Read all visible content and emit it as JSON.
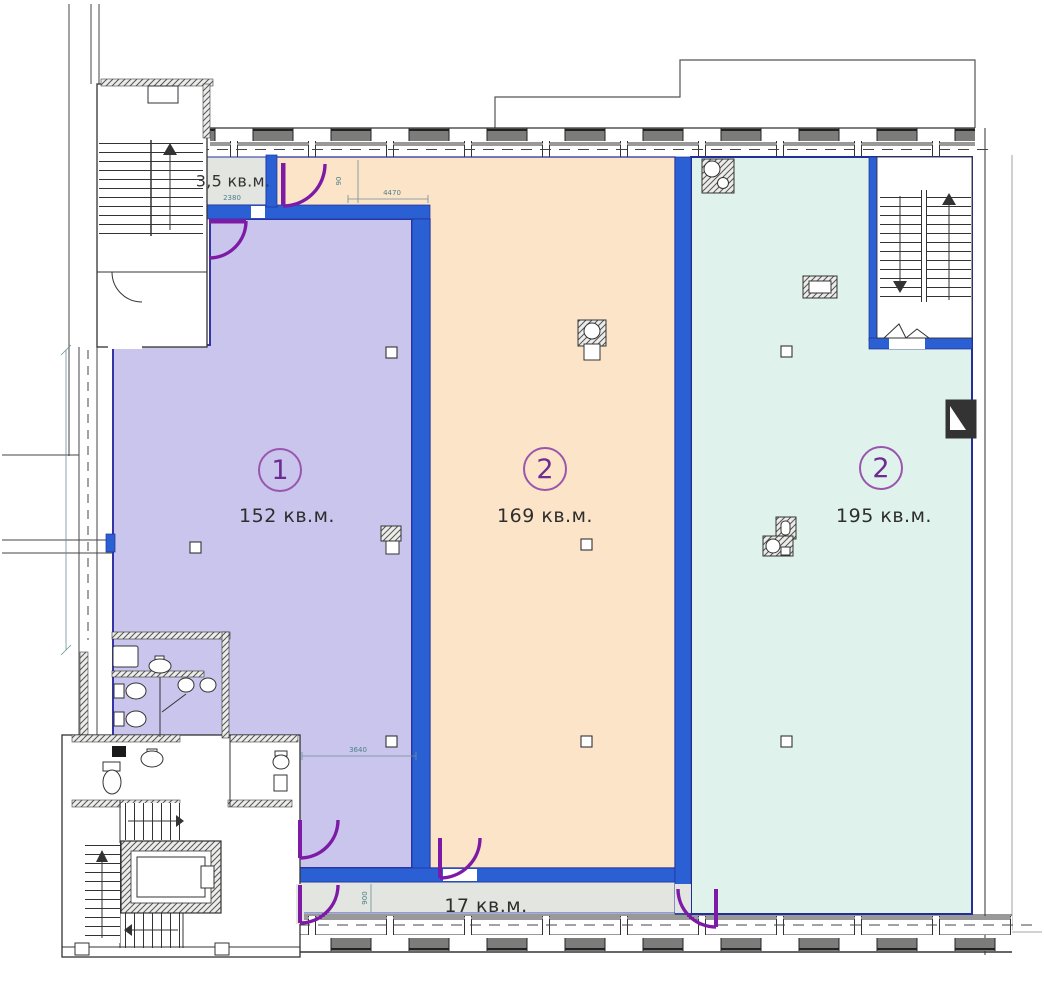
{
  "rooms": [
    {
      "number": "1",
      "area": "152 кв.м."
    },
    {
      "number": "2",
      "area": "169 кв.м."
    },
    {
      "number": "2",
      "area": "195 кв.м."
    }
  ],
  "annexes": [
    {
      "area": "3,5 кв.м."
    },
    {
      "area": "17 кв.м."
    }
  ],
  "dimensions": {
    "d2380": "2380",
    "d4470": "4470",
    "d90": "90",
    "d3640": "3640",
    "d900": "900"
  },
  "colors": {
    "room1_fill": "#c9c5ec",
    "room2_fill": "#fbe4c8",
    "room3_fill": "#dff3ec",
    "gray_room": "#e3e5e1",
    "wall_blue": "#2b60d5",
    "door_purple": "#7d1ba6",
    "outline_navy": "#232e9b",
    "label_purple": "#6d2c92"
  }
}
